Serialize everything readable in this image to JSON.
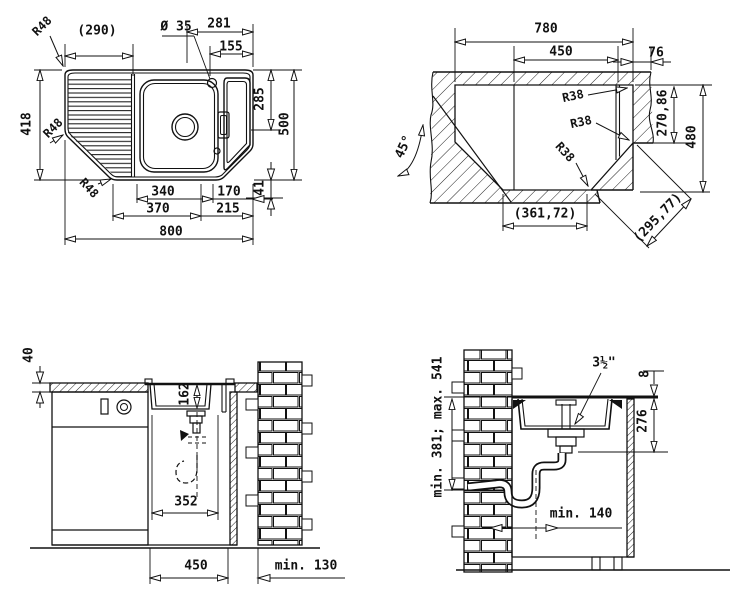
{
  "v1": {
    "d290": "(290)",
    "d281": "281",
    "d35": "Ø 35",
    "d155": "155",
    "r48a": "R48",
    "r48b": "R48",
    "r48c": "R48",
    "d418": "418",
    "d285": "285",
    "d500": "500",
    "d41": "41",
    "d340": "340",
    "d170": "170",
    "d370": "370",
    "d215": "215",
    "d800": "800"
  },
  "v2": {
    "d780": "780",
    "d450": "450",
    "d76": "76",
    "r38a": "R38",
    "r38b": "R38",
    "r38c": "R38",
    "a45": "45°",
    "d27086": "270,86",
    "d480": "480",
    "d36172": "(361,72)",
    "d29577": "(295,77)"
  },
  "v3": {
    "d40": "40",
    "d162": "162",
    "d352": "352",
    "d450": "450",
    "dmin130": "min. 130"
  },
  "v4": {
    "dminmax": "min. 381; max. 541",
    "d312": "3½\"",
    "d8": "8",
    "d276": "276",
    "dmin140": "min. 140"
  }
}
